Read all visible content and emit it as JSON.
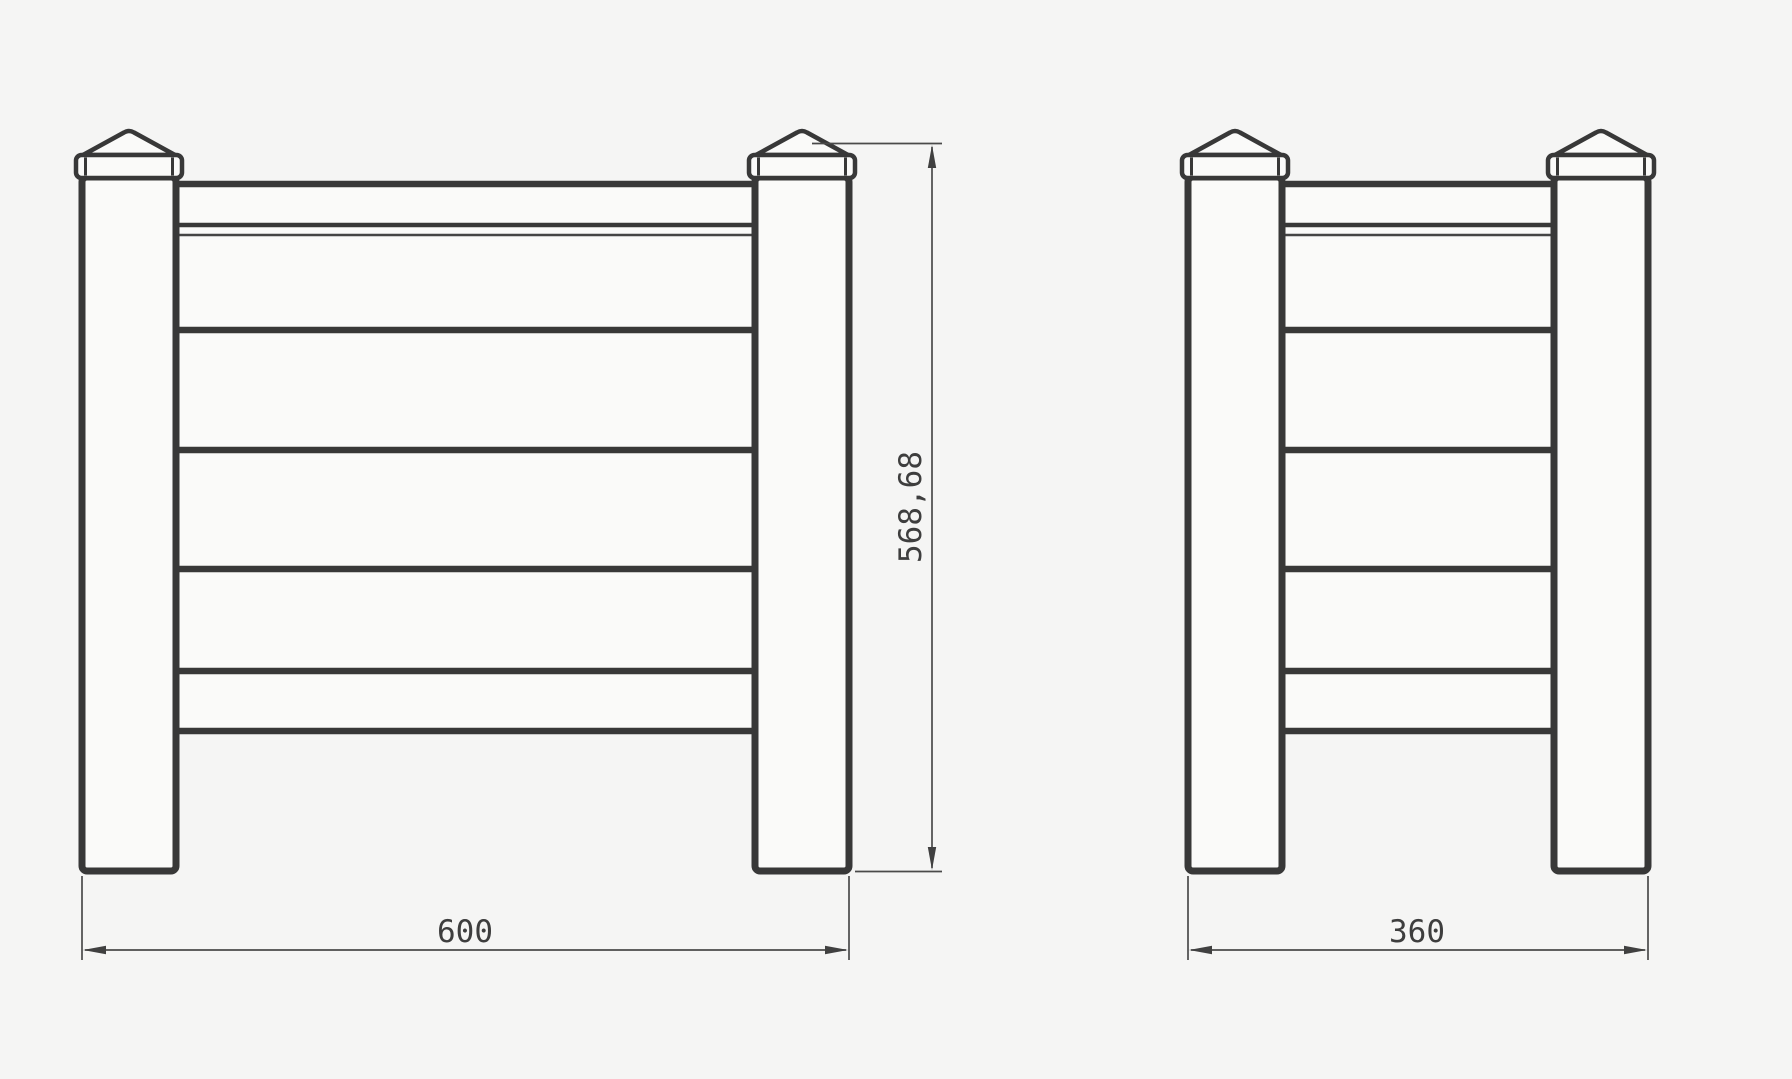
{
  "drawing": {
    "kind": "fence-panel-technical-drawing",
    "colors": {
      "background": "#f5f5f4",
      "structure_line": "#383838",
      "dimension_line": "#4a4a4a",
      "panel_fill": "#fafaf9",
      "text": "#3e3e3e"
    }
  },
  "labels": {
    "height": "568,68",
    "front_width": "600",
    "side_width": "360"
  },
  "views": [
    {
      "name": "front-panel-elevation",
      "width_label": "600",
      "height_label": "568,68"
    },
    {
      "name": "side-panel-elevation",
      "width_label": "360"
    }
  ]
}
